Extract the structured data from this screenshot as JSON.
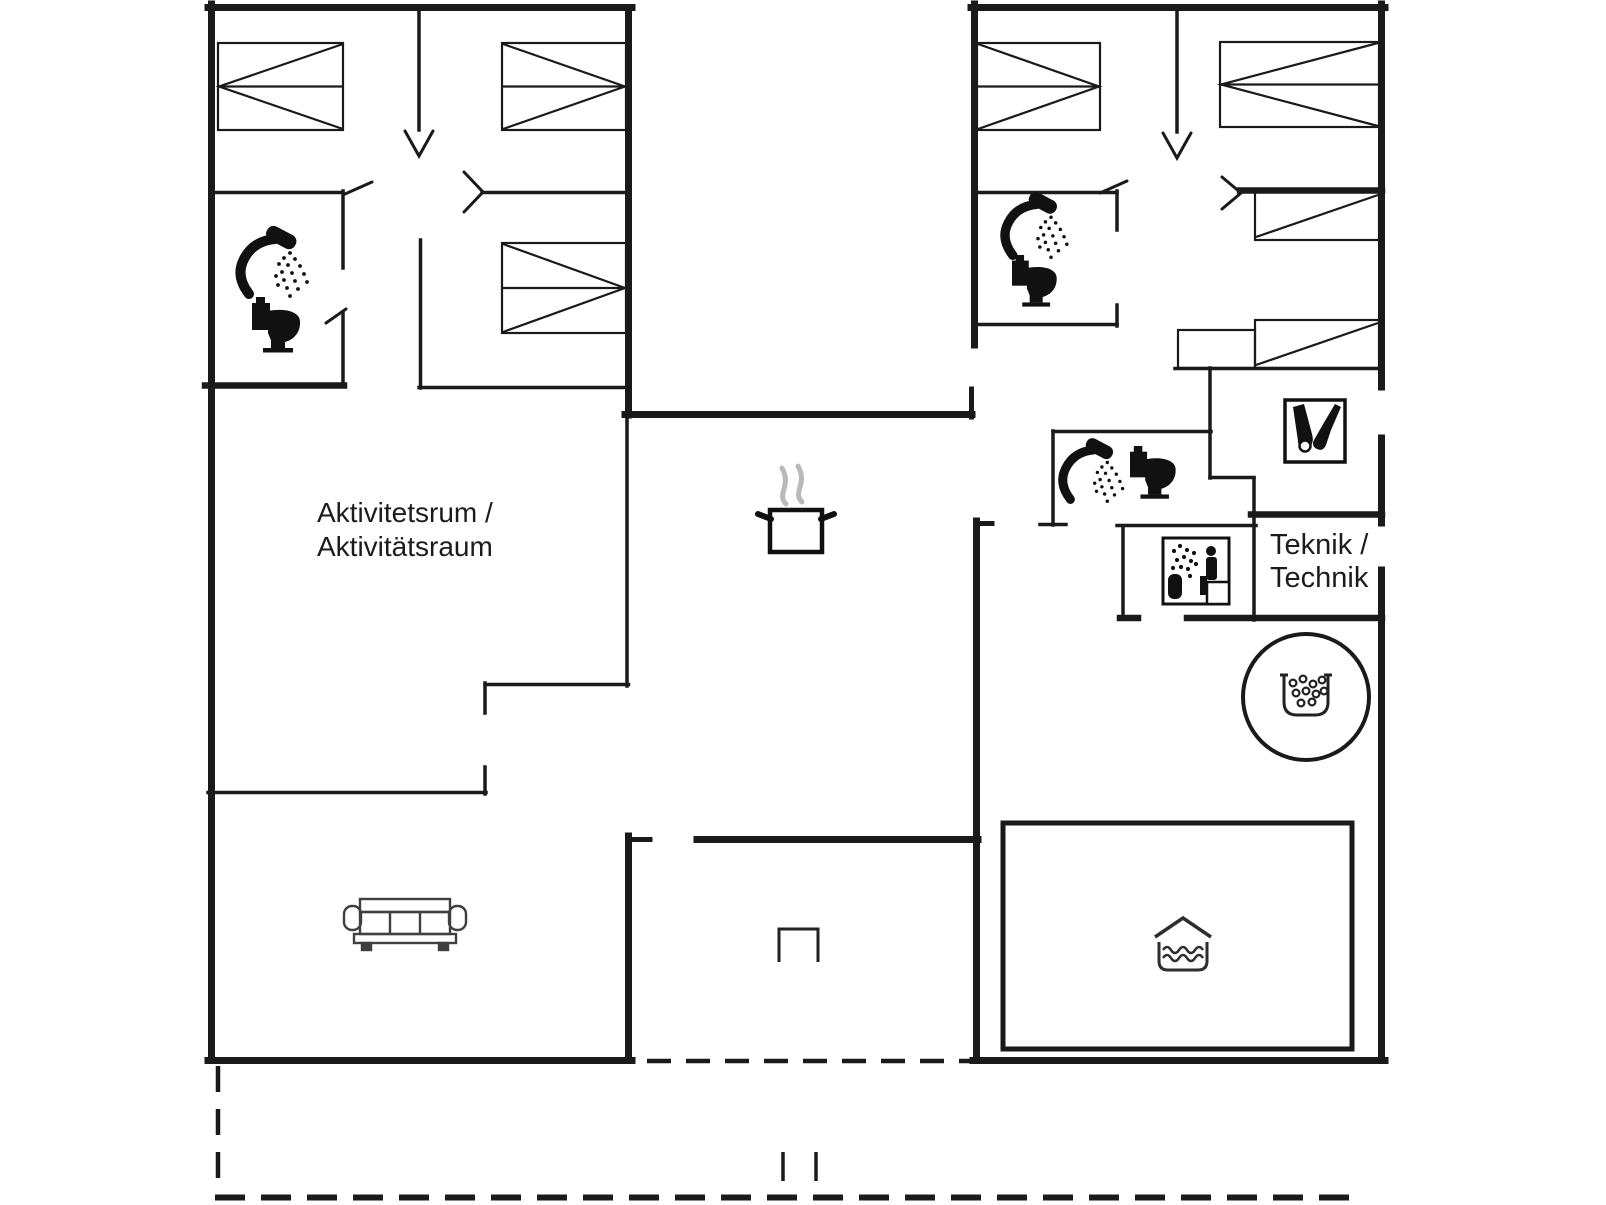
{
  "title": "Holiday house floor plan",
  "colors": {
    "background": "#ffffff",
    "wall": "#1a1a1a",
    "icon": "#111111",
    "steam": "#b9b9b9",
    "furniture": "#3f3f3f"
  },
  "labels": {
    "activity_room": {
      "line1": "Aktivitetsrum /",
      "line2": "Aktivitätsraum"
    },
    "tech_room": {
      "line1": "Teknik /",
      "line2": "Technik"
    }
  },
  "icons": [
    "shower-icon",
    "toilet-icon",
    "sauna-icon",
    "cleaning-icon",
    "cooking-pot-icon",
    "sofa-icon",
    "whirlpool-icon",
    "indoor-pool-icon",
    "grill-icon",
    "bed-symbol",
    "door-swing-mark",
    "terrace-dashed-boundary"
  ]
}
